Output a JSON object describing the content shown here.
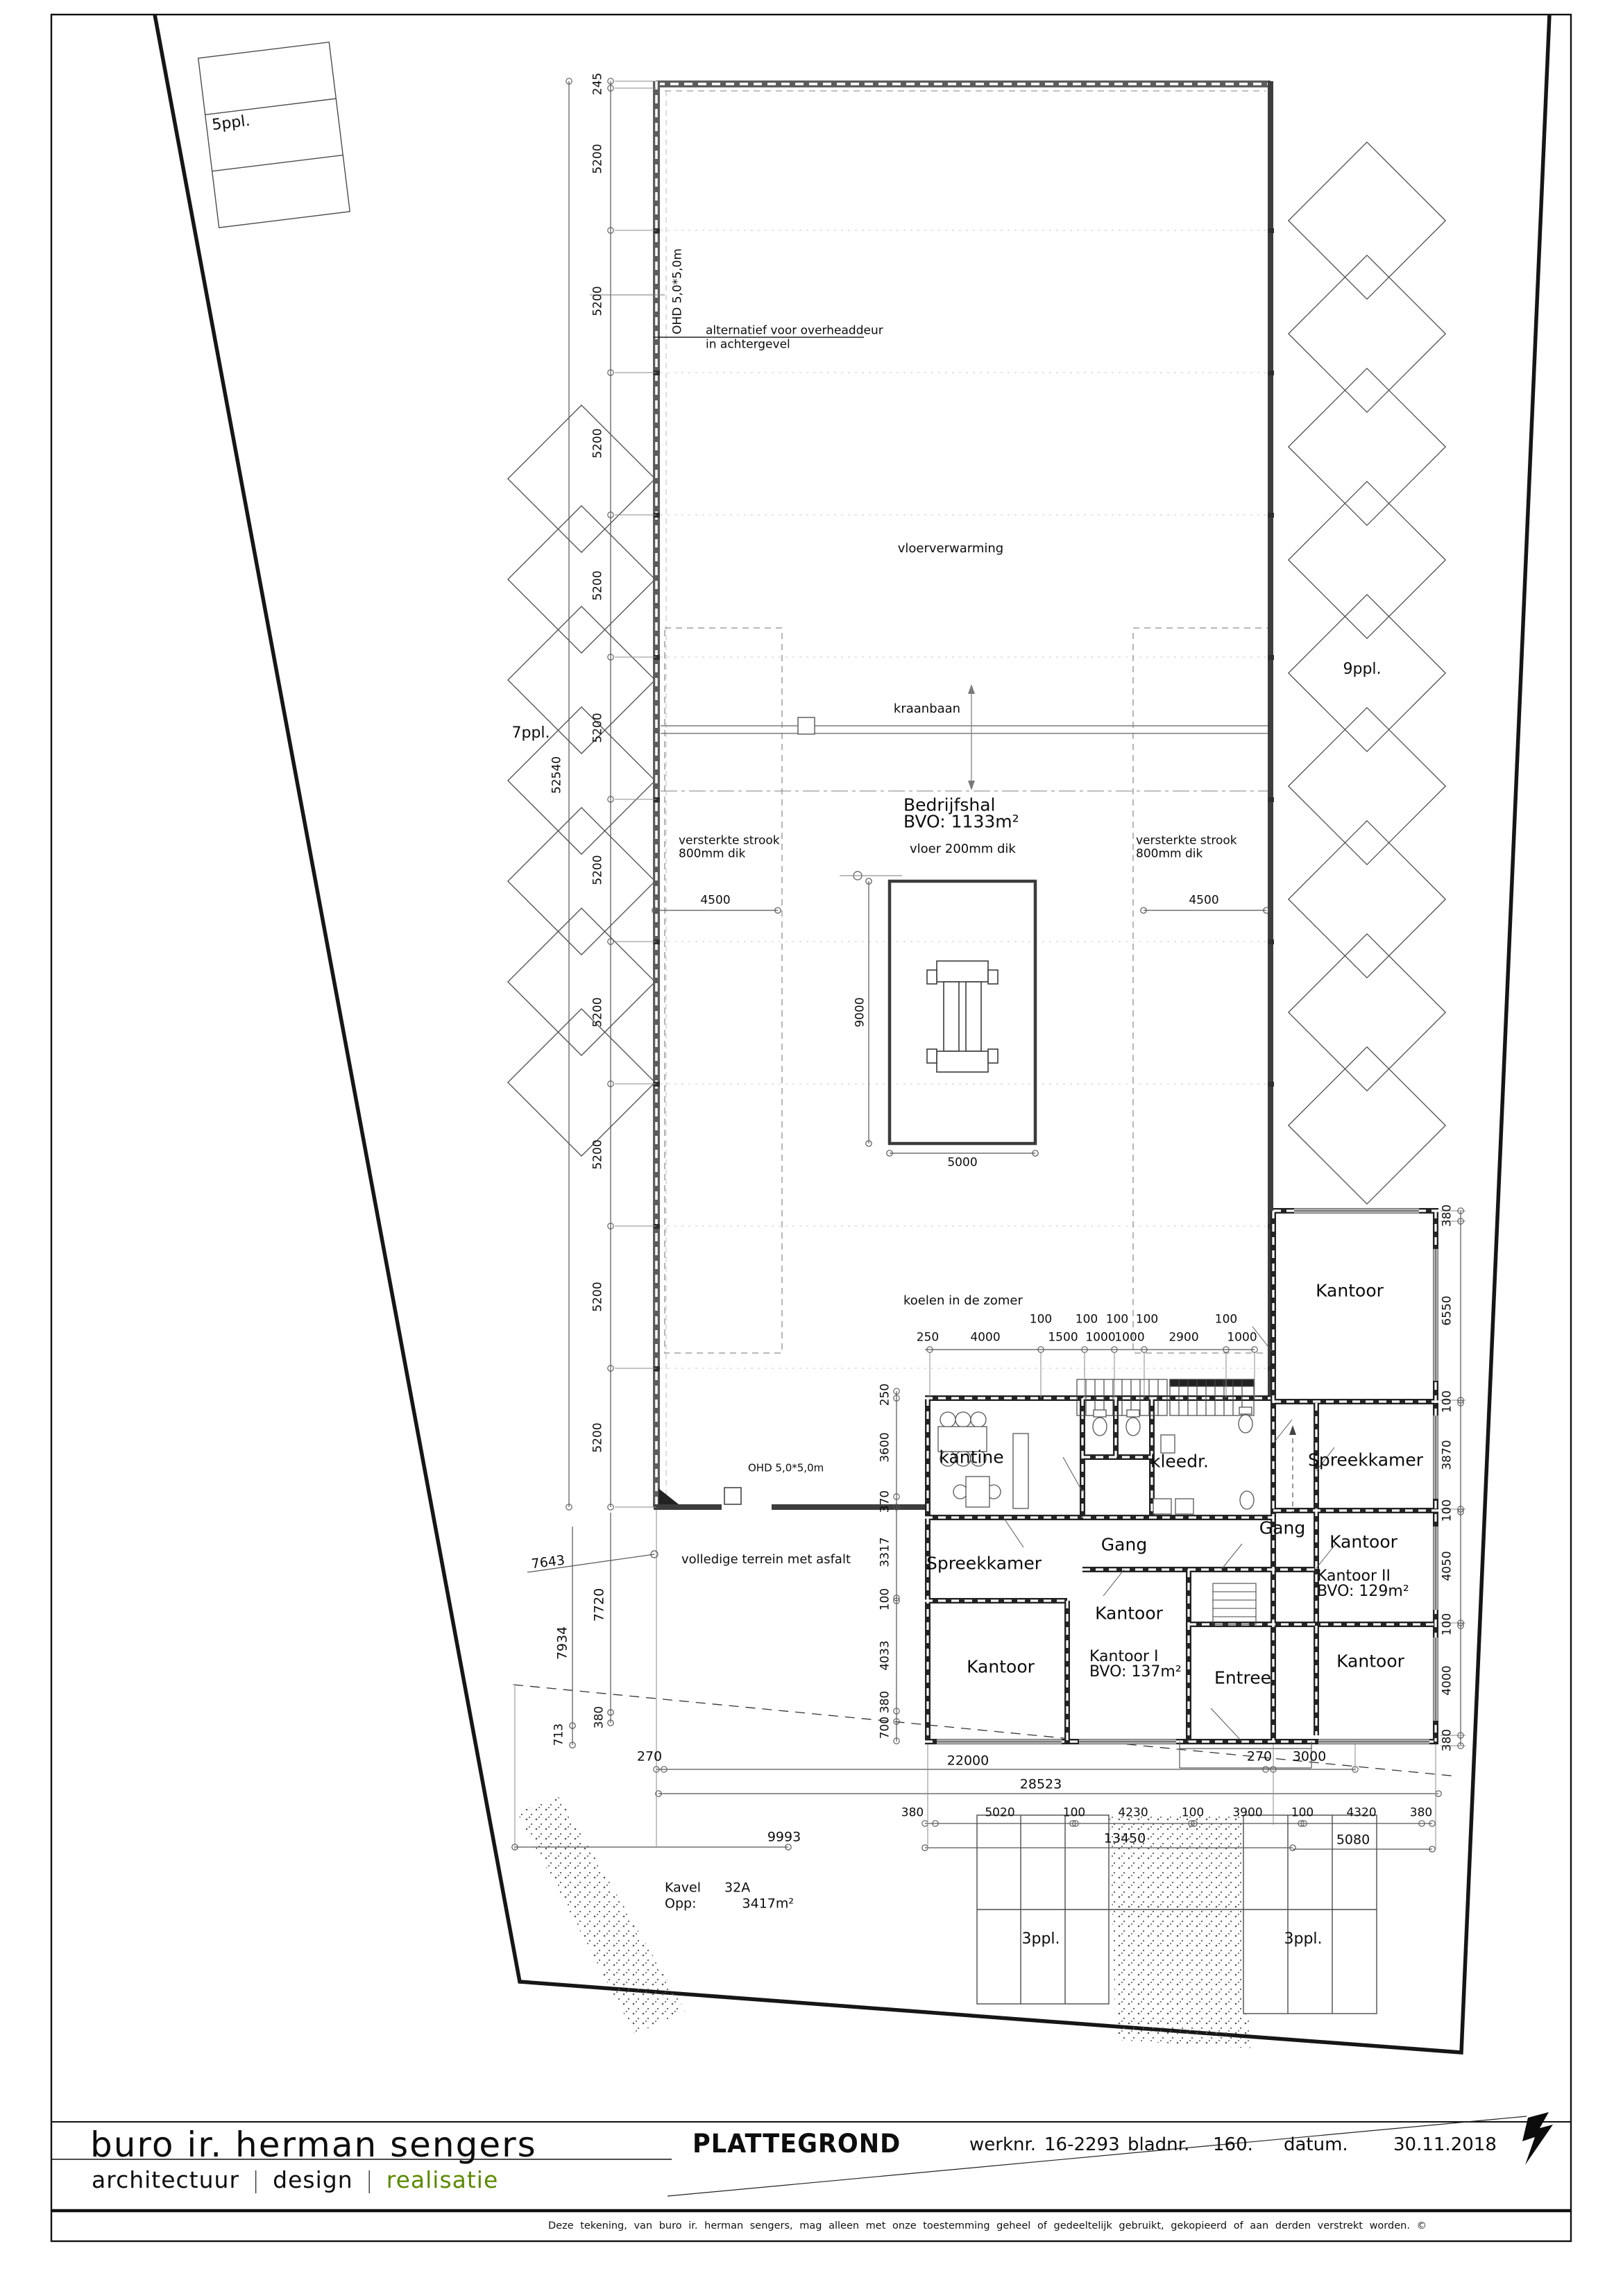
{
  "title_block": {
    "company": "buro ir. herman sengers",
    "tagline": [
      "architectuur",
      "design",
      "realisatie"
    ],
    "sep": "|",
    "drawing_type": "PLATTEGROND",
    "werknr_label": "werknr.",
    "werknr": "16-2293",
    "bladnr_label": "bladnr.",
    "bladnr": "160.",
    "datum_label": "datum.",
    "datum": "30.11.2018",
    "disclaimer": "Deze tekening, van buro ir. herman sengers, mag alleen met onze toestemming geheel of gedeeltelijk gebruikt, gekopieerd of aan derden verstrekt worden. ©",
    "accent_green": "#5a8a00"
  },
  "rooms": {
    "bedrijfshal_name": "Bedrijfshal",
    "bedrijfshal_area": "BVO: 1133m²",
    "kantine": "kantine",
    "kleedr": "kleedr.",
    "gang_h": "Gang",
    "gang_v": "Gang",
    "spreekkamer_l": "Spreekkamer",
    "spreekkamer_r": "Spreekkamer",
    "kantoor_tr": "Kantoor",
    "kantoor_mr": "Kantoor",
    "kantoor2_name": "Kantoor II",
    "kantoor2_area": "BVO: 129m²",
    "kantoor_lr": "Kantoor",
    "kantoor_bl": "Kantoor",
    "kantoor_c": "Kantoor",
    "kantoor1_name": "Kantoor I",
    "kantoor1_area": "BVO: 137m²",
    "entree": "Entree"
  },
  "annotations": {
    "vloerverwarming": "vloerverwarming",
    "kraanbaan": "kraanbaan",
    "vloer": "vloer 200mm dik",
    "versterkte_line1": "versterkte strook",
    "versterkte_line2": "800mm dik",
    "koelen": "koelen in de zomer",
    "ohd_v": "OHD 5,0*5,0m",
    "ohd_h": "OHD 5,0*5,0m",
    "alternatief_line1": "alternatief voor overheaddeur",
    "alternatief_line2": "in achtergevel",
    "asfalt": "volledige terrein met asfalt",
    "kavel_label": "Kavel",
    "kavel_nr": "32A",
    "opp_label": "Opp:",
    "opp_value": "3417m²"
  },
  "parking": {
    "p5": "5ppl.",
    "p7": "7ppl.",
    "p9": "9ppl.",
    "p3a": "3ppl.",
    "p3b": "3ppl."
  },
  "dims": {
    "left_col": [
      "245",
      "5200",
      "5200",
      "5200",
      "5200",
      "5200",
      "5200",
      "5200",
      "5200",
      "5200",
      "5200"
    ],
    "left_total": "52540",
    "right_col": [
      "380",
      "6550",
      "100",
      "3870",
      "100",
      "4050",
      "100",
      "4000",
      "380"
    ],
    "office_left_col": [
      "250",
      "3600",
      "370",
      "3317",
      "100",
      "4033",
      "380",
      "700"
    ],
    "top_small": [
      "100",
      "100",
      "100",
      "100",
      "100"
    ],
    "top_main": [
      "250",
      "4000",
      "1500",
      "1000",
      "1000",
      "2900",
      "1000"
    ],
    "hall_4500_l": "4500",
    "hall_4500_r": "4500",
    "found_h": "9000",
    "found_w": "5000",
    "row1": [
      "270",
      "22000",
      "270",
      "3000"
    ],
    "row2": "28523",
    "chain": [
      "380",
      "5020",
      "100",
      "4230",
      "100",
      "3900",
      "100",
      "4320",
      "380"
    ],
    "row4": [
      "9993",
      "13450",
      "5080"
    ],
    "left_site": [
      "7643",
      "7720",
      "7934",
      "713",
      "380"
    ]
  }
}
